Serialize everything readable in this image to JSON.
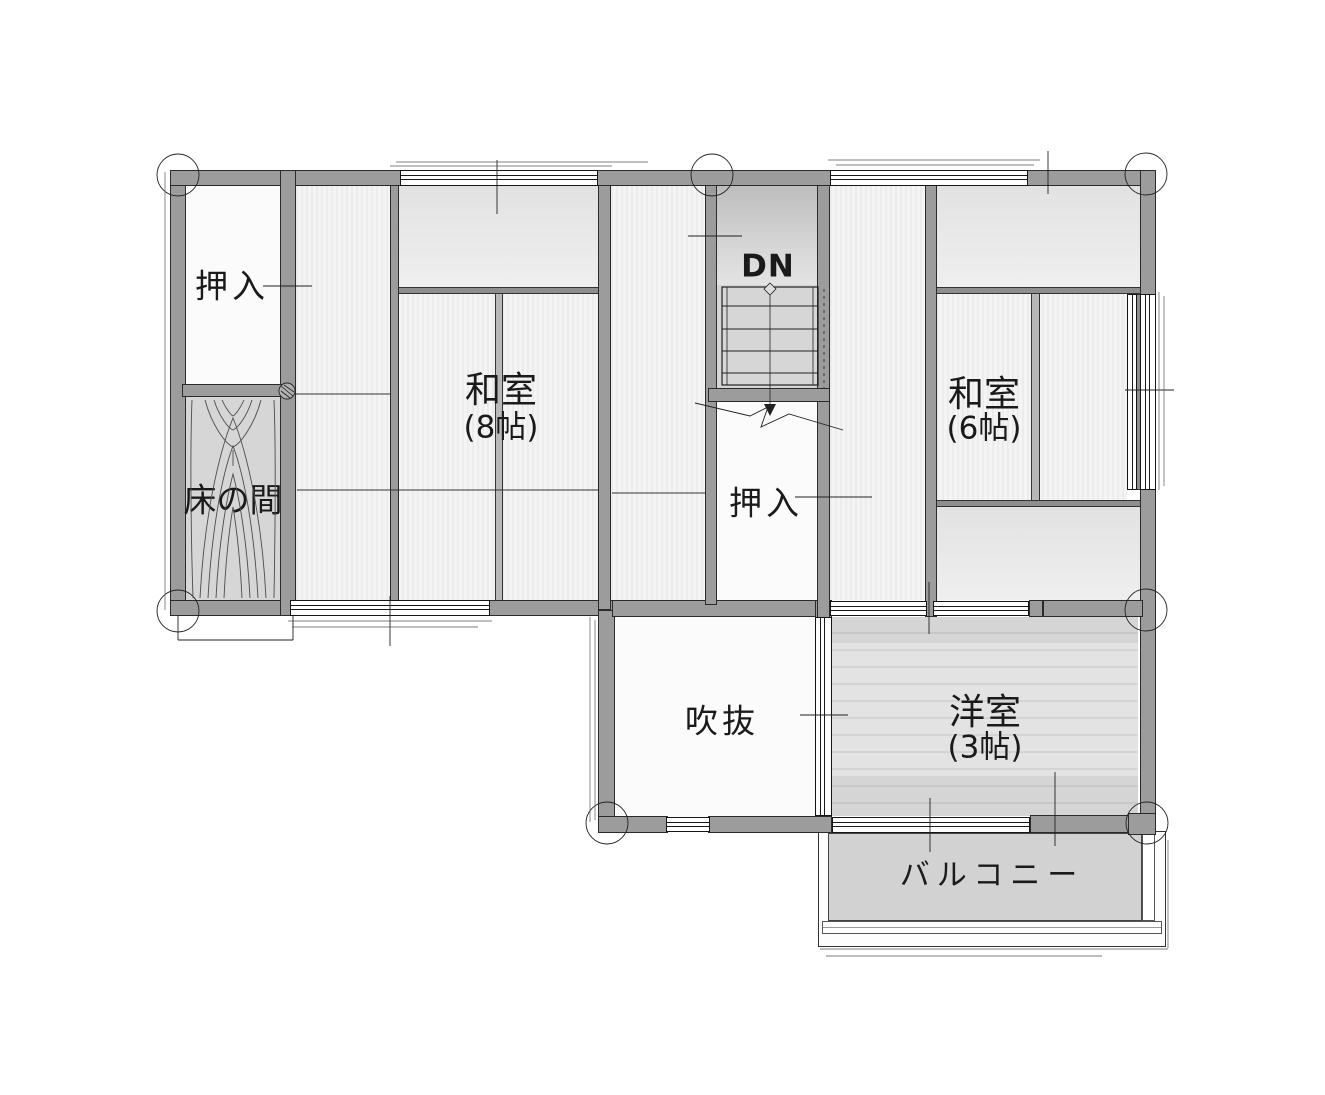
{
  "rooms": {
    "closet_top_left": {
      "label": "押入"
    },
    "tokonoma": {
      "label": "床の間"
    },
    "washitsu8": {
      "label": "和室",
      "size": "(8帖)"
    },
    "stairs_down": {
      "label": "DN"
    },
    "closet_center": {
      "label": "押入"
    },
    "washitsu6": {
      "label": "和室",
      "size": "(6帖)"
    },
    "atrium_void": {
      "label": "吹抜"
    },
    "western_room": {
      "label": "洋室",
      "size": "(3帖)"
    },
    "balcony": {
      "label": "バルコニー"
    }
  },
  "colors": {
    "wall": "#9c9c9c",
    "wall-edge": "#2b2b2b",
    "line": "#222222",
    "tatami-a": "#ececec",
    "tatami-b": "#f4f4f4",
    "band-top": "#e2e2e2",
    "band-bottom": "#efefef",
    "wood": "#d6d6d6",
    "white-room": "#fbfbfb",
    "balcony": "#d2d2d2",
    "text": "#1a1a1a"
  }
}
